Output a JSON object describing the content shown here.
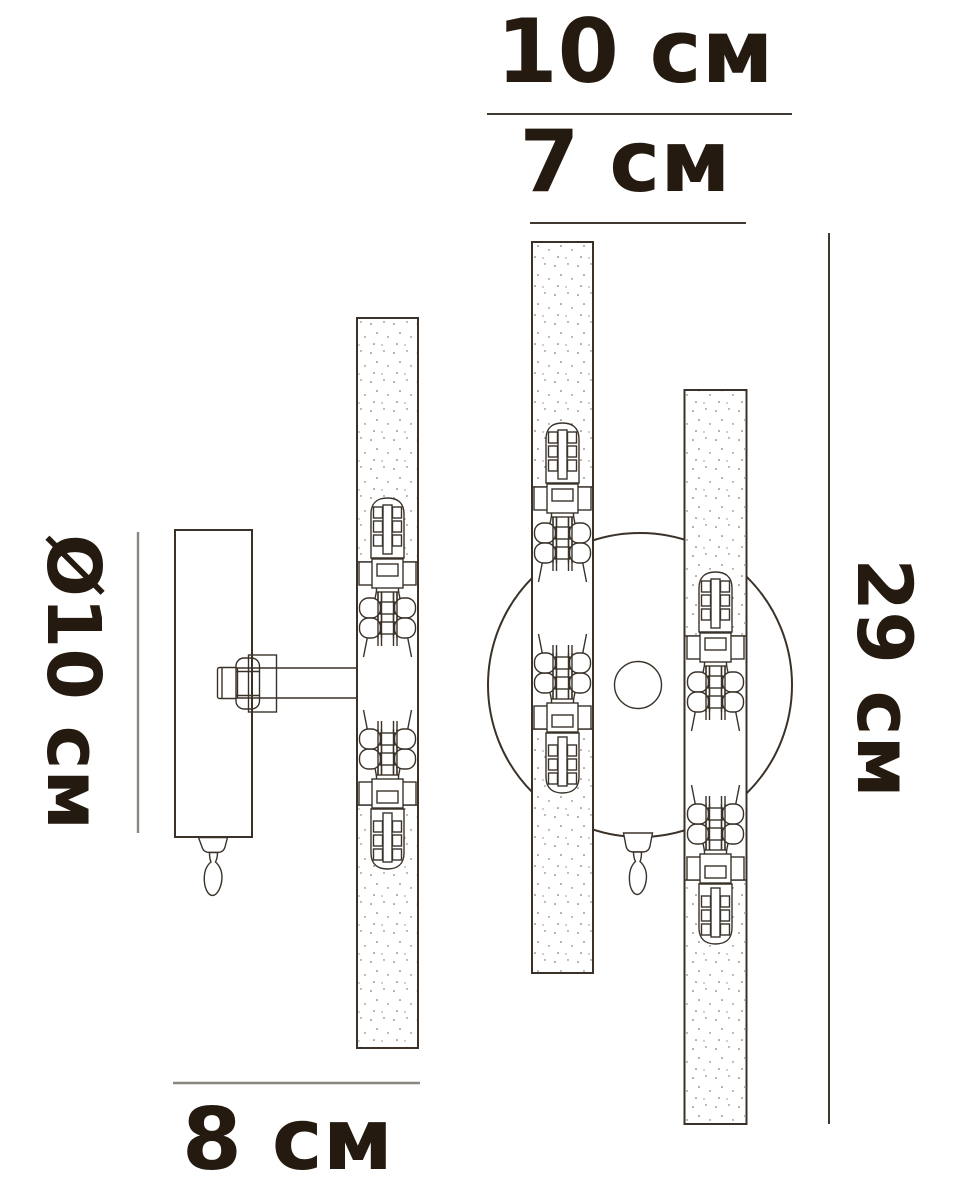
{
  "diagram": {
    "unit": "см",
    "dimensions": {
      "backplate_width": {
        "label": "10 см",
        "value": 10
      },
      "tube_span_width": {
        "label": "7 см",
        "value": 7
      },
      "overall_height": {
        "label": "29 см",
        "value": 29
      },
      "side_depth": {
        "label": "8 см",
        "value": 8
      },
      "backplate_diameter": {
        "label": "Ø10 см",
        "value": 10
      }
    },
    "colors": {
      "background": "#ffffff",
      "drawing_line": "#3a3229",
      "dimension_line_dark": "#3f3931",
      "dimension_line_light": "#8a867f",
      "text": "#241a10"
    }
  }
}
